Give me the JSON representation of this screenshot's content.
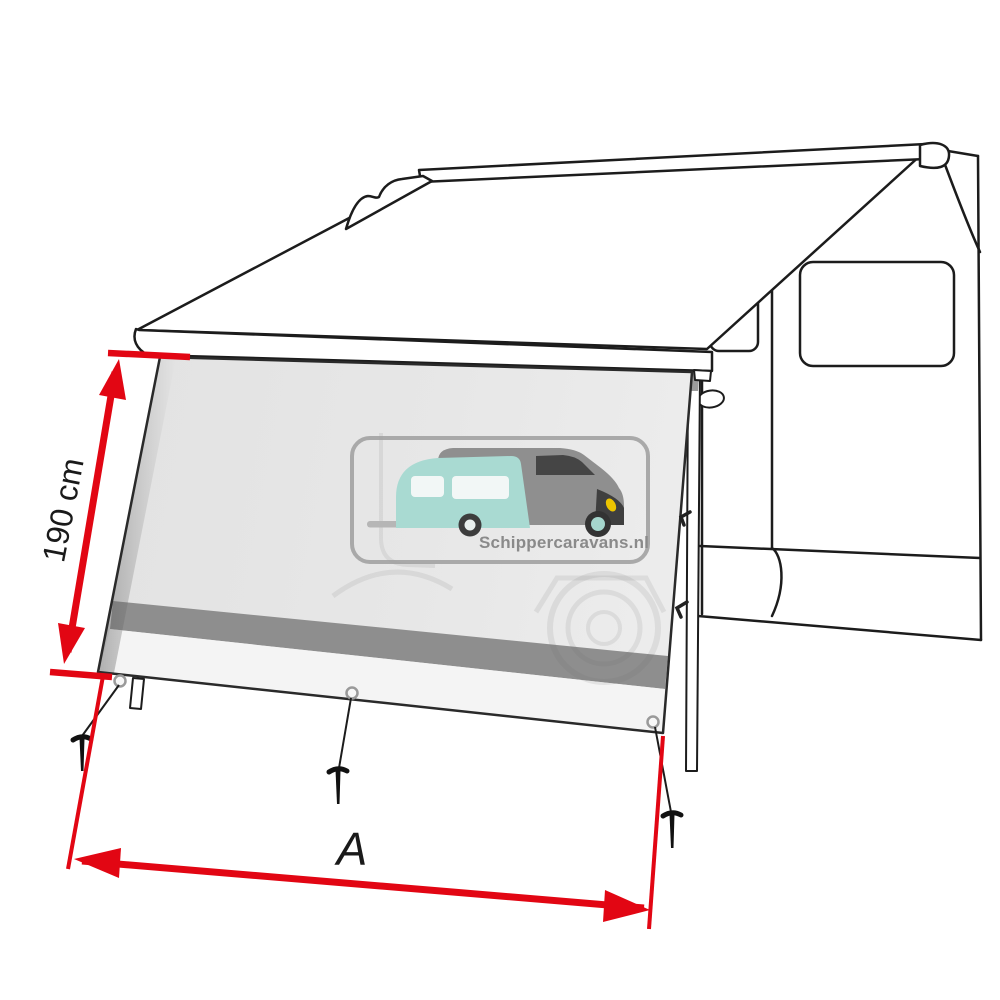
{
  "diagram": {
    "dimensions": {
      "height_label": "190 cm",
      "width_label": "A"
    },
    "watermark": {
      "site_text": "Schippercaravans.nl"
    },
    "colors": {
      "dimension_red": "#e20613",
      "outline_black": "#1c1c1c",
      "panel_gray": "#e7e7e7",
      "band_gray": "#8e8e8e",
      "hem_white": "#f4f4f4",
      "logo_teal": "#a9dad2",
      "logo_gray": "#8f8f8f",
      "headlight_yellow": "#ecc400"
    }
  }
}
